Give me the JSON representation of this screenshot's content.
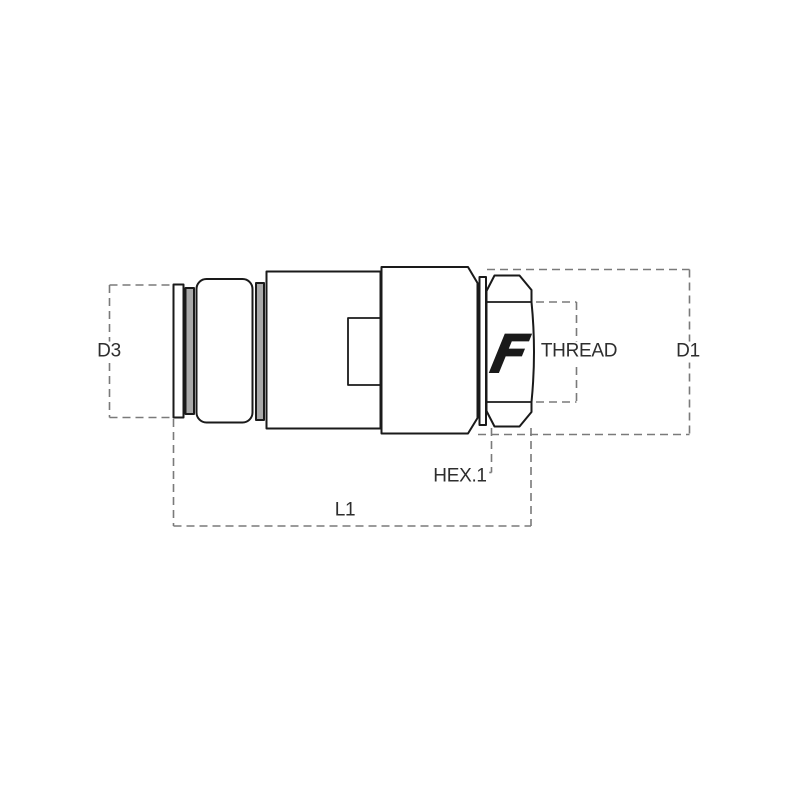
{
  "drawing": {
    "kind": "technical-drawing",
    "subject": "quick-release hydraulic coupling, side elevation",
    "brand_mark": "F",
    "labels": {
      "d3": "D3",
      "thread": "THREAD",
      "d1": "D1",
      "hex1": "HEX.1",
      "l1": "L1"
    },
    "colors": {
      "background": "#ffffff",
      "outline": "#1a1a1a",
      "dashed_line": "#7a7a7a",
      "metal_gray": "#a9a9a9",
      "label_text": "#2e2e2e"
    }
  }
}
